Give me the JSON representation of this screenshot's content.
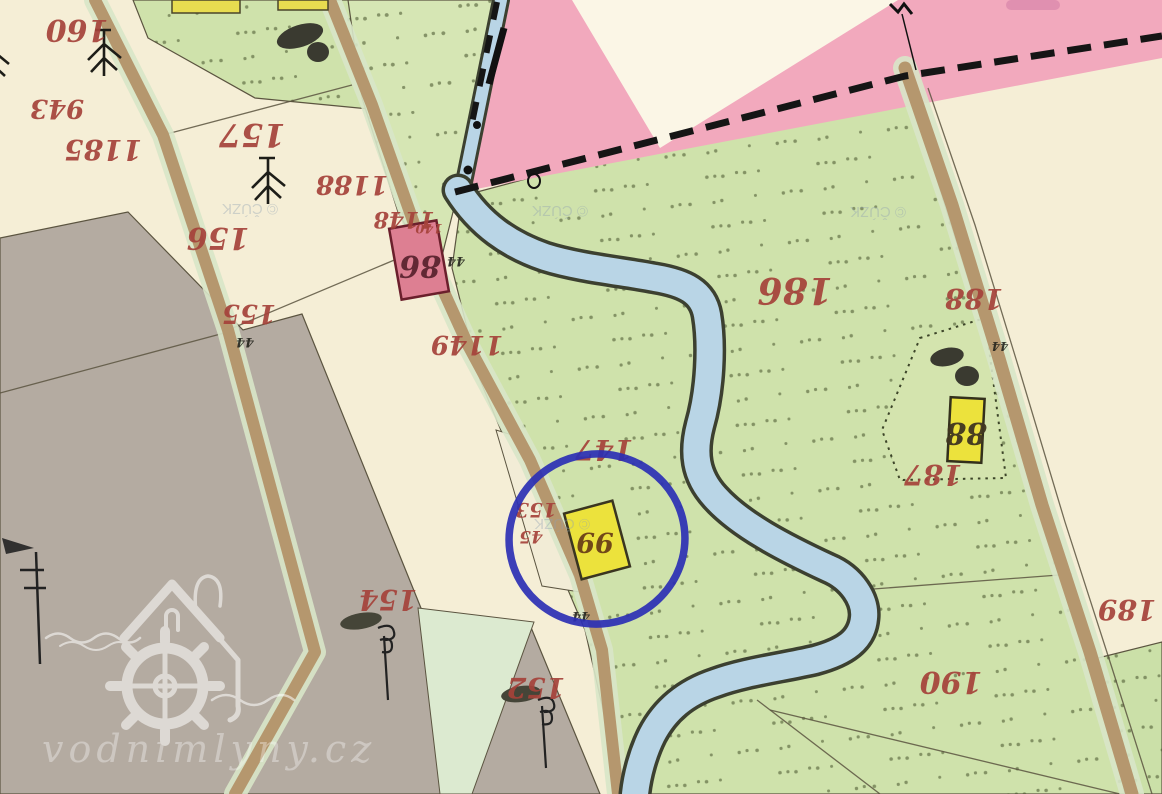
{
  "map": {
    "type": "historical-cadastral-map",
    "source_watermark": "vodnimlyny.cz",
    "attribution": "© ČÚZK",
    "annotation": {
      "shape": "hand-drawn-circle",
      "color": "#2b2fb4",
      "highlights": "mill building 99 by the stream"
    },
    "parcel_labels": [
      {
        "text": "160"
      },
      {
        "text": "943"
      },
      {
        "text": "1185"
      },
      {
        "text": "157"
      },
      {
        "text": "156"
      },
      {
        "text": "155"
      },
      {
        "text": "1188"
      },
      {
        "text": "1148"
      },
      {
        "text": "140"
      },
      {
        "text": "1149"
      },
      {
        "text": "147"
      },
      {
        "text": "153"
      },
      {
        "text": "45"
      },
      {
        "text": "154"
      },
      {
        "text": "152"
      },
      {
        "text": "186"
      },
      {
        "text": "188"
      },
      {
        "text": "187"
      },
      {
        "text": "189"
      },
      {
        "text": "190"
      }
    ],
    "building_labels": [
      {
        "text": "86"
      },
      {
        "text": "99"
      },
      {
        "text": "88"
      }
    ],
    "survey_marks": [
      {
        "text": "44"
      },
      {
        "text": "44"
      },
      {
        "text": "44"
      },
      {
        "text": "44"
      }
    ],
    "colors": {
      "meadow_green": "#cfe2ab",
      "field_cream": "#f5eed6",
      "pasture_gray": "#b4aba1",
      "water_blue": "#b9d5e6",
      "road_tan": "#b5976e",
      "village_pink": "#f2a9bd",
      "building_yellow": "#ece23c",
      "building_pink": "#dd7f92",
      "label_red": "#a5423a",
      "annotation_blue": "#2b2fb4"
    }
  }
}
